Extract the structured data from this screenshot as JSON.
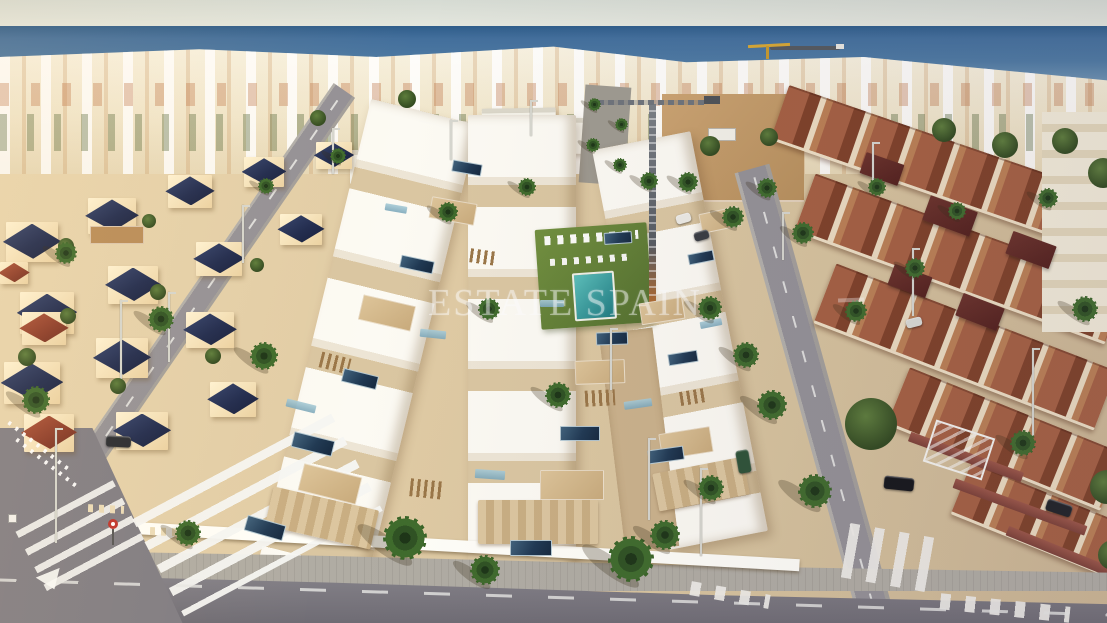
{
  "meta": {
    "type": "aerial-photograph",
    "subject": "Aerial view of a new-build development of white villas by the sea"
  },
  "watermark": {
    "text": "ESTATE SPAIN"
  },
  "scene": {
    "sky": "Pale hazy sky",
    "sea": "Mediterranean sea on the horizon",
    "breakwater": "Harbour breakwater",
    "harbour_crane": "Yellow harbour crane",
    "coastal_town": "Dense coastal town of white low-rise buildings",
    "left_villas": "Existing villas with navy pyramid roofs",
    "new_villas": "Row of new white flat-roof villas with roof terraces and solar panels",
    "phase_buildings": "White buildings under construction",
    "boulevard": "Tree-lined boulevard toward the beach",
    "dirt_lot": "Empty construction plot",
    "garden_pool": "Communal garden with swimming pool and sun loungers",
    "pool": "Swimming pool",
    "townhouses": "Terracotta-roofed townhouses",
    "far_buildings": "Cream apartment buildings",
    "left_road": "Street along the west side of the development",
    "right_road": "Street with parked cars along the east side",
    "bottom_road": "Asphalt street in the foreground",
    "junction": "Road junction",
    "sidewalk": "Paved sidewalk",
    "wall": "White perimeter wall",
    "zebra": "Zebra pedestrian crossing",
    "lane_markings": "Road lane markings",
    "give_way": "Give-way road marking",
    "sign_round": "Round traffic sign",
    "sign_square": "Traffic sign",
    "tower_crane": "Tower crane on construction site",
    "billboard": "White construction billboard",
    "white_pergola": "White pergola structure",
    "brick_wall": "Brick garden wall",
    "palm": "Palm tree",
    "tree": "Green tree",
    "shadow": "Cast shadow",
    "villa": "Villa with pyramid roof",
    "roof": "Pyramid roof",
    "solar": "Rooftop solar panel",
    "glass": "Glass balustrade",
    "terrace": "Rooftop terrace",
    "pergola": "Timber pergola",
    "stone": "Stone-clad wall",
    "car": "Parked car",
    "streetlight": "Street light",
    "fence": "White fence",
    "loungers": "Sun loungers",
    "watermark": "Translucent agency watermark",
    "light": "Warm evening light"
  },
  "colors": {
    "sky": "#dfe3da",
    "sea": "#46749e",
    "sand": "#d9c6a2",
    "villaWhite": "#fbf9f2",
    "solarNavy": "#24395a",
    "navyRoof": "#20294a",
    "terracotta": "#96523a",
    "roadGrey": "#94919 6",
    "asphalt": "#76737a",
    "lawn": "#64823a",
    "pool": "#2f8a8c",
    "palmGreen": "#3c6329",
    "cream": "#f2e8d2",
    "watermark": "rgba(255,255,255,0.44)"
  }
}
